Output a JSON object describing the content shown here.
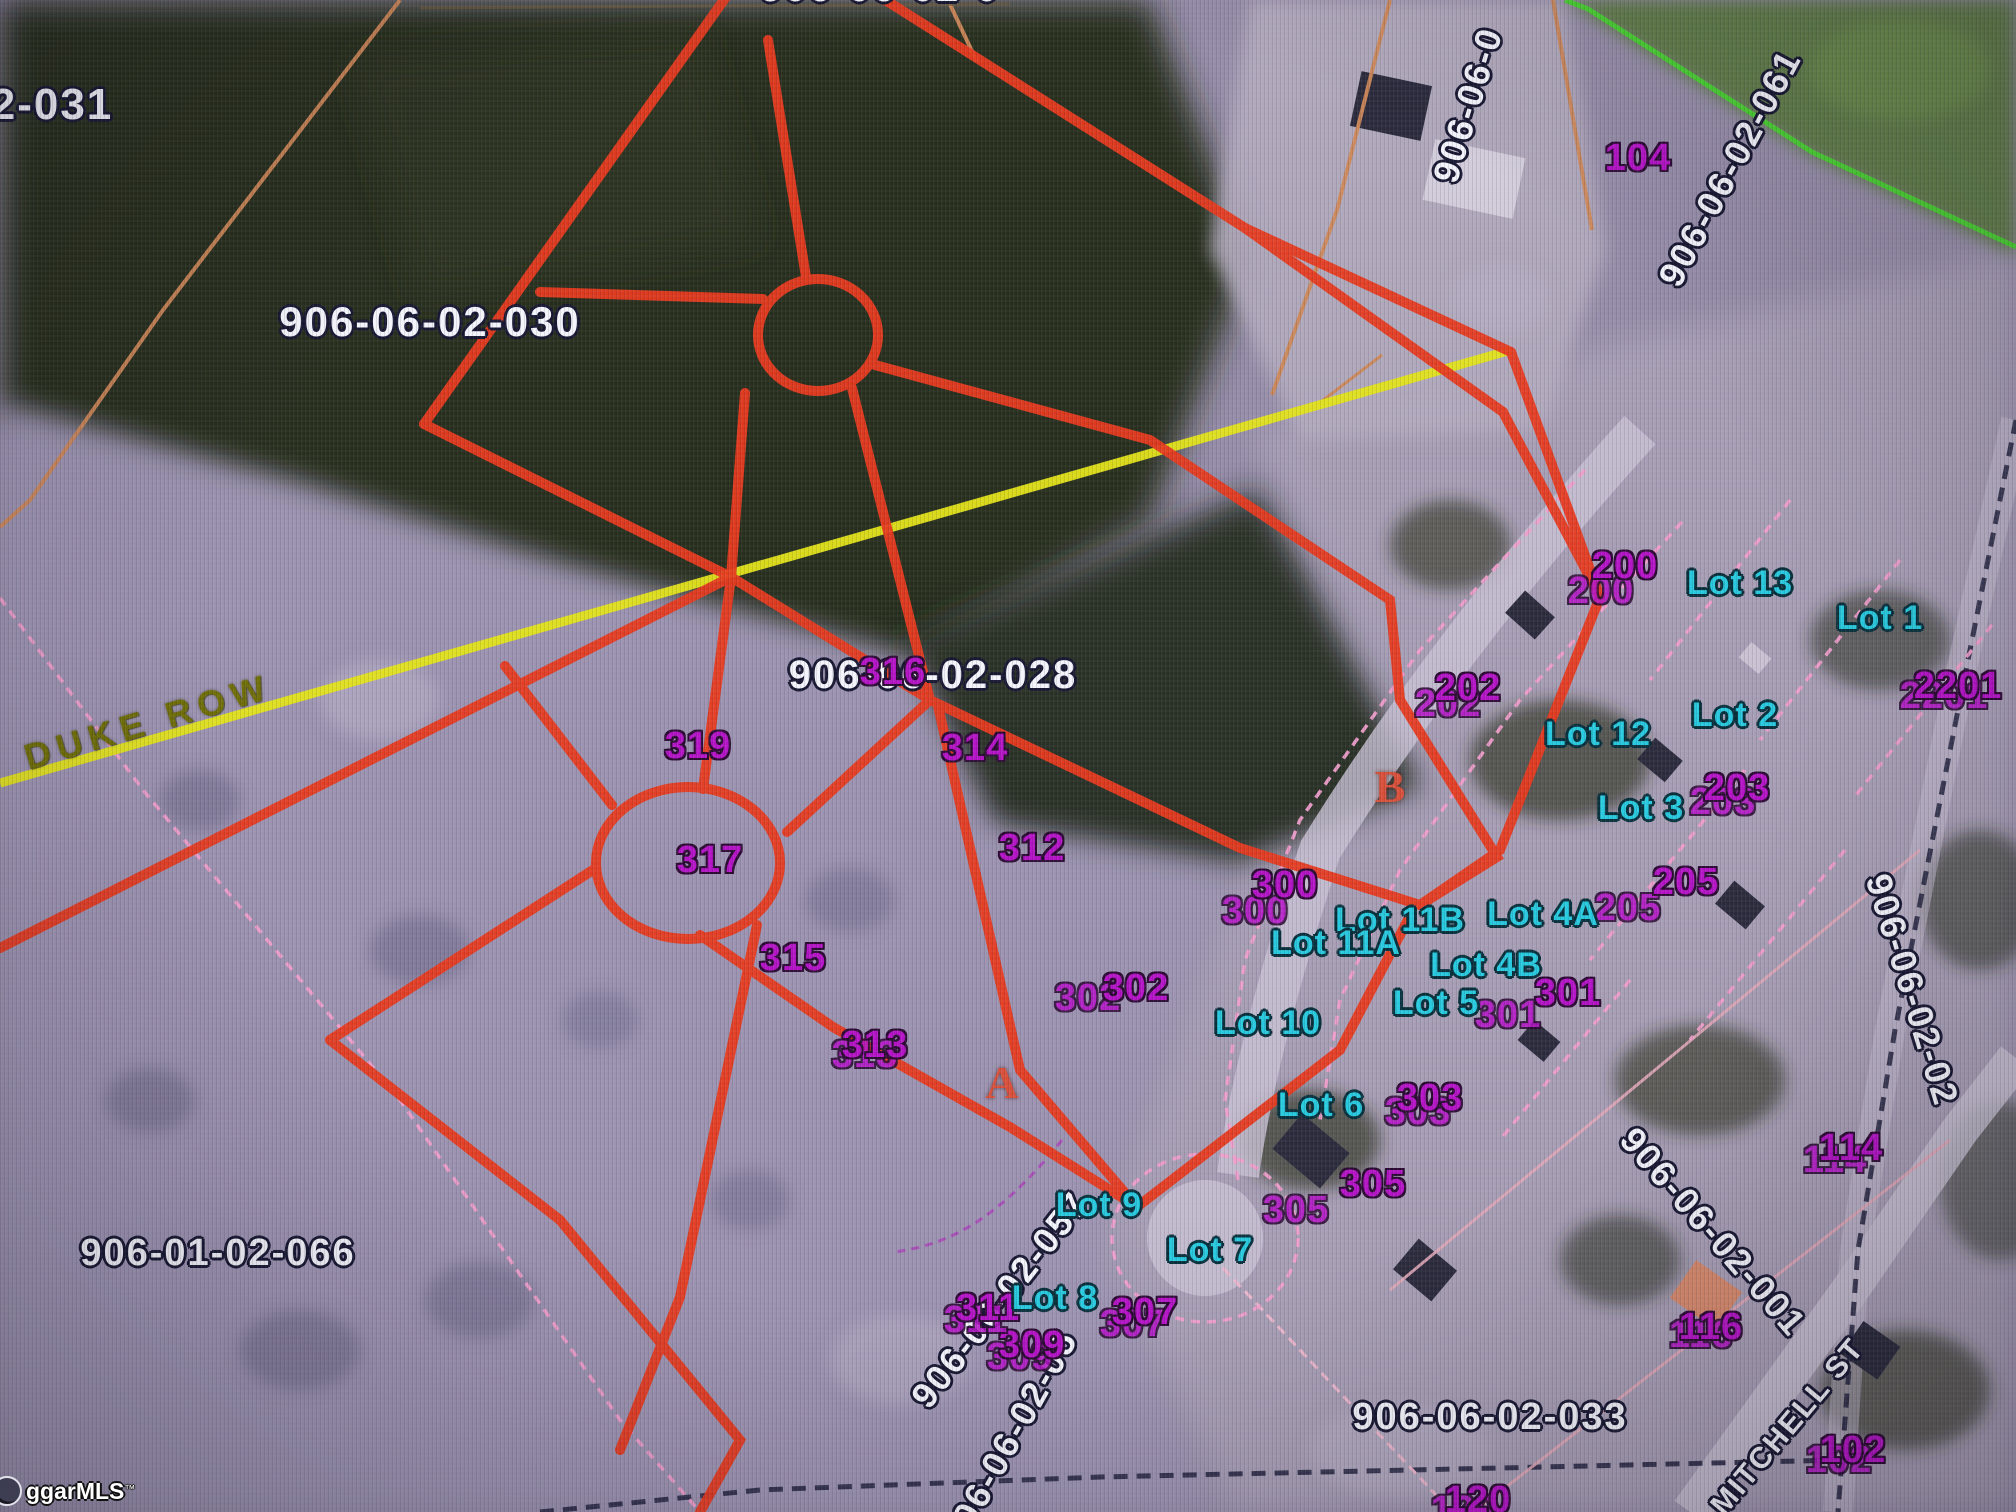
{
  "map": {
    "type": "county-gis-parcel-aerial",
    "watermark": {
      "text": "ggarMLS",
      "tm": "™"
    }
  },
  "colors": {
    "parcel_outline_red": "#e63a1f",
    "road_centerline_yellow": "#e3e31a",
    "adjacent_parcel_green": "#4ad133",
    "parcel_line_tan": "#cd8757",
    "lot_line_pink_dashed": "#ef9ecb",
    "right_of_way_navy_dashed": "#23233f",
    "label_white": "#f3f3fb",
    "label_purple": "#b414c6",
    "label_cyan": "#28c9de",
    "section_letter_red": "#d9503a",
    "street_text_olive": "#6f6e08"
  },
  "labels": {
    "parcels_white": [
      {
        "text": "2-031",
        "x": 52,
        "y": 105,
        "rot": 0,
        "size": 44
      },
      {
        "text": "906-06-02-0",
        "x": 880,
        "y": -12,
        "rot": 0,
        "size": 40
      },
      {
        "text": "906-06-02-030",
        "x": 430,
        "y": 322,
        "rot": 0,
        "size": 42
      },
      {
        "text": "906-06-02-028",
        "x": 933,
        "y": 675,
        "rot": 0,
        "size": 40
      },
      {
        "text": "906-01-02-066",
        "x": 218,
        "y": 1253,
        "rot": 0,
        "size": 38
      },
      {
        "text": "906-06-02-033",
        "x": 1490,
        "y": 1417,
        "rot": 0,
        "size": 38
      },
      {
        "text": "906-06-0",
        "x": 1468,
        "y": 105,
        "rot": -73,
        "size": 36
      },
      {
        "text": "906-06-02-061",
        "x": 1730,
        "y": 168,
        "rot": -62,
        "size": 36
      },
      {
        "text": "906-06-02-057",
        "x": 1000,
        "y": 1300,
        "rot": -52,
        "size": 36
      },
      {
        "text": "906-06-02-05",
        "x": 1010,
        "y": 1438,
        "rot": -61,
        "size": 36
      },
      {
        "text": "906-06-02-001",
        "x": 1713,
        "y": 1232,
        "rot": 49,
        "size": 36
      },
      {
        "text": "906-06-02-02",
        "x": 1912,
        "y": 990,
        "rot": 73,
        "size": 36
      }
    ],
    "house_numbers_purple": [
      {
        "text": "104",
        "x": 1638,
        "y": 158,
        "doubled": false
      },
      {
        "text": "200",
        "x": 1625,
        "y": 566,
        "doubled": true,
        "dx": -24,
        "dy": 25
      },
      {
        "text": "202",
        "x": 1468,
        "y": 688,
        "doubled": true,
        "dx": -20,
        "dy": 16
      },
      {
        "text": "2201",
        "x": 1958,
        "y": 686,
        "doubled": true,
        "dx": -14,
        "dy": 10
      },
      {
        "text": "203",
        "x": 1737,
        "y": 788,
        "doubled": true,
        "dx": -14,
        "dy": 14
      },
      {
        "text": "205",
        "x": 1686,
        "y": 882,
        "doubled": true,
        "dx": -58,
        "dy": 26
      },
      {
        "text": "300",
        "x": 1285,
        "y": 885,
        "doubled": true,
        "dx": -30,
        "dy": 26
      },
      {
        "text": "301",
        "x": 1568,
        "y": 993,
        "doubled": true,
        "dx": -60,
        "dy": 22
      },
      {
        "text": "302",
        "x": 1136,
        "y": 988,
        "doubled": true,
        "dx": -48,
        "dy": 10
      },
      {
        "text": "303",
        "x": 1430,
        "y": 1098,
        "doubled": true,
        "dx": -12,
        "dy": 14
      },
      {
        "text": "305",
        "x": 1373,
        "y": 1184,
        "doubled": true,
        "dx": -77,
        "dy": 26
      },
      {
        "text": "307",
        "x": 1145,
        "y": 1312,
        "doubled": true,
        "dx": -12,
        "dy": 12
      },
      {
        "text": "309",
        "x": 1032,
        "y": 1345,
        "doubled": true,
        "dx": -12,
        "dy": 12
      },
      {
        "text": "311",
        "x": 988,
        "y": 1308,
        "doubled": true,
        "dx": -12,
        "dy": 12
      },
      {
        "text": "312",
        "x": 1032,
        "y": 848,
        "doubled": false
      },
      {
        "text": "313",
        "x": 875,
        "y": 1045,
        "doubled": true,
        "dx": -10,
        "dy": 10
      },
      {
        "text": "314",
        "x": 975,
        "y": 748,
        "doubled": false
      },
      {
        "text": "315",
        "x": 793,
        "y": 958,
        "doubled": false
      },
      {
        "text": "316",
        "x": 893,
        "y": 672,
        "doubled": false
      },
      {
        "text": "317",
        "x": 710,
        "y": 860,
        "doubled": false
      },
      {
        "text": "319",
        "x": 698,
        "y": 746,
        "doubled": false
      },
      {
        "text": "114",
        "x": 1851,
        "y": 1148,
        "doubled": true,
        "dx": -16,
        "dy": 12
      },
      {
        "text": "116",
        "x": 1711,
        "y": 1327,
        "doubled": true,
        "dx": -10,
        "dy": 8
      },
      {
        "text": "102",
        "x": 1853,
        "y": 1450,
        "doubled": true,
        "dx": -14,
        "dy": 10
      },
      {
        "text": "120",
        "x": 1478,
        "y": 1500,
        "doubled": true,
        "dx": -14,
        "dy": 10
      }
    ],
    "lots_cyan": [
      {
        "text": "Lot 13",
        "x": 1740,
        "y": 583
      },
      {
        "text": "Lot 1",
        "x": 1880,
        "y": 618
      },
      {
        "text": "Lot 12",
        "x": 1598,
        "y": 734
      },
      {
        "text": "Lot 2",
        "x": 1735,
        "y": 715
      },
      {
        "text": "Lot 3",
        "x": 1641,
        "y": 808
      },
      {
        "text": "Lot 4A",
        "x": 1543,
        "y": 914
      },
      {
        "text": "Lot 11B",
        "x": 1400,
        "y": 920
      },
      {
        "text": "Lot 11A",
        "x": 1336,
        "y": 943
      },
      {
        "text": "Lot 4B",
        "x": 1486,
        "y": 965
      },
      {
        "text": "Lot 5",
        "x": 1436,
        "y": 1003
      },
      {
        "text": "Lot 10",
        "x": 1268,
        "y": 1023
      },
      {
        "text": "Lot 6",
        "x": 1321,
        "y": 1105
      },
      {
        "text": "Lot 9",
        "x": 1099,
        "y": 1205
      },
      {
        "text": "Lot 7",
        "x": 1210,
        "y": 1250
      },
      {
        "text": "Lot 8",
        "x": 1055,
        "y": 1298
      }
    ],
    "section_letters_red": [
      {
        "text": "A",
        "x": 1002,
        "y": 1083
      },
      {
        "text": "B",
        "x": 1390,
        "y": 787
      }
    ],
    "streets": [
      {
        "text": "DUKE ROW",
        "x": 148,
        "y": 722,
        "rot": -16.5,
        "style": "duke",
        "size": 36
      },
      {
        "text": "MITCHELL ST",
        "x": 1788,
        "y": 1427,
        "rot": -50,
        "style": "white",
        "size": 30
      }
    ]
  }
}
